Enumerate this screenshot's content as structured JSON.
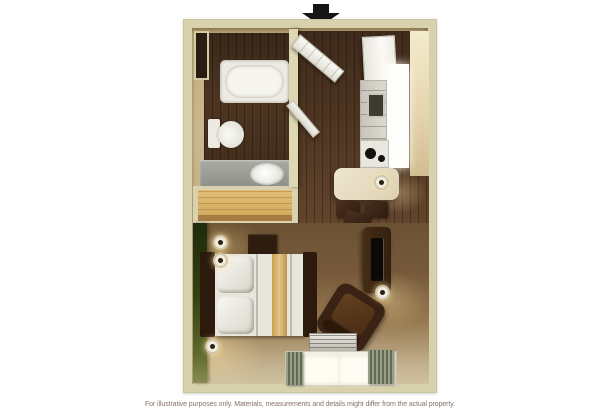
{
  "caption": {
    "text": "For illustrative purposes only.  Materials, measurements and details might differ from the actual property."
  },
  "icons": {
    "entrance_arrow": "black-down-arrow-entrance-marker",
    "wall_sconce": "round-wall-lamp"
  },
  "palette": {
    "wall_outer": "#d7d1ac",
    "wall_inner_tan": "#c9b489",
    "wood_floor_dark": "#46301e",
    "carpet_dark": "#6b5233",
    "carpet_light": "#cfc1a0",
    "accent_wall_green": "#33400f",
    "closet_wood": "#d9b56a",
    "fixture_white": "#eceae2",
    "vanity_gray": "#9d9d97",
    "furniture_dark_brown": "#38220f",
    "bedding_gold": "#d3af67",
    "table_cream": "#e8dec6",
    "arrow_black": "#151515"
  }
}
